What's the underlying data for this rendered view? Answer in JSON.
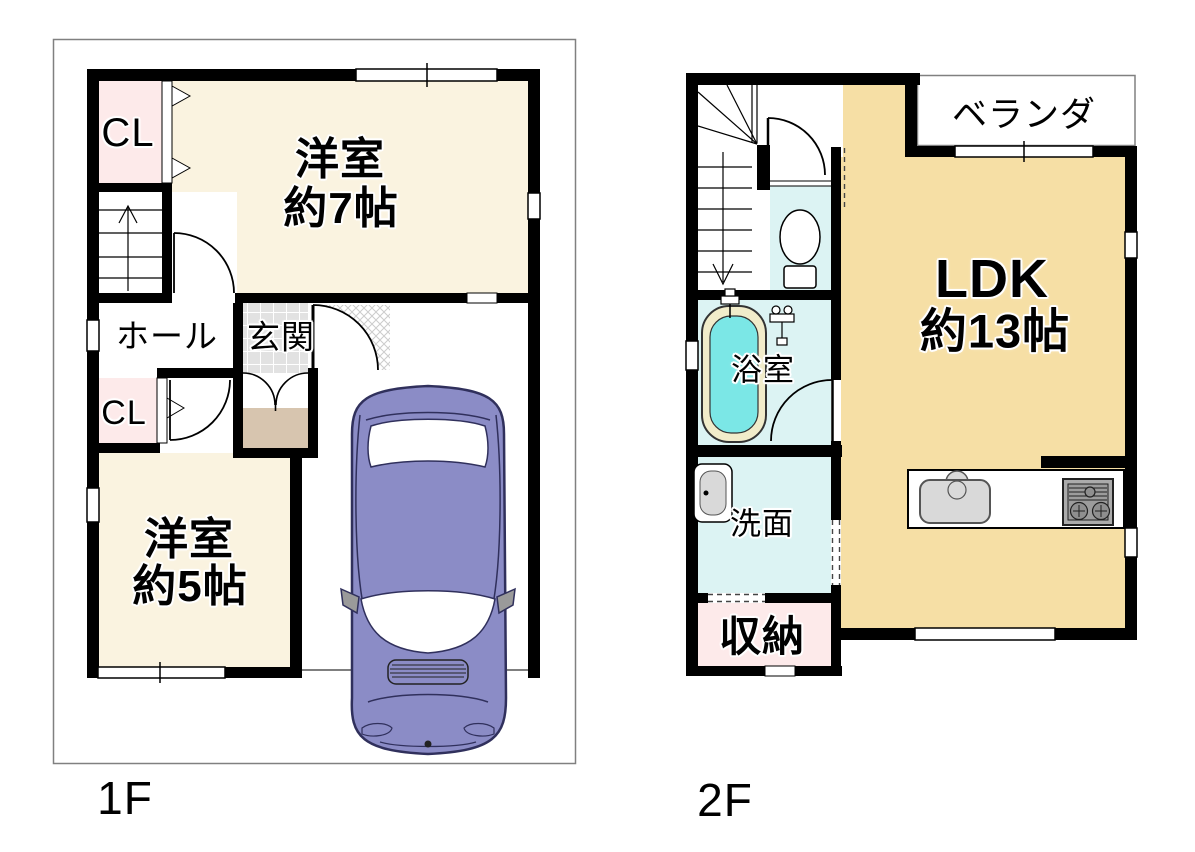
{
  "page": {
    "type": "floor-plan",
    "background": "#ffffff"
  },
  "floors": [
    {
      "name": "1F",
      "rooms": [
        {
          "key": "closet-upper",
          "label": "CL"
        },
        {
          "key": "western-room-7",
          "lines": [
            "洋室",
            "約7帖"
          ]
        },
        {
          "key": "hall",
          "label": "ホール"
        },
        {
          "key": "entrance",
          "label": "玄関"
        },
        {
          "key": "closet-lower",
          "label": "CL"
        },
        {
          "key": "western-room-5",
          "lines": [
            "洋室",
            "約5帖"
          ]
        }
      ],
      "icons": [
        "stairs-up-icon",
        "car-icon",
        "door-arc-icon",
        "closet-door-icon",
        "window-icon"
      ]
    },
    {
      "name": "2F",
      "rooms": [
        {
          "key": "veranda",
          "label": "ベランダ"
        },
        {
          "key": "ldk",
          "lines": [
            "LDK",
            "約13帖"
          ]
        },
        {
          "key": "bathroom",
          "label": "浴室"
        },
        {
          "key": "washroom",
          "label": "洗面"
        },
        {
          "key": "storage",
          "label": "収納"
        }
      ],
      "icons": [
        "stairs-down-icon",
        "toilet-icon",
        "bathtub-icon",
        "shower-mixer-icon",
        "washbasin-icon",
        "kitchen-sink-icon",
        "stove-icon",
        "window-icon"
      ]
    }
  ],
  "colors": {
    "wall": "#000000",
    "room_cream": "#faf3e0",
    "room_tan": "#f6dfa5",
    "room_pink": "#fdeaea",
    "room_cyan": "#dcf3f3",
    "bathtub_water": "#7be7e6",
    "bathtub_rim": "#f1ecca",
    "entrance_tile": "#e2e2e2",
    "entrance_step": "#d7c5af",
    "car_body": "#8b8cc6",
    "car_outline": "#30305c",
    "lot_boundary": "#808080"
  }
}
